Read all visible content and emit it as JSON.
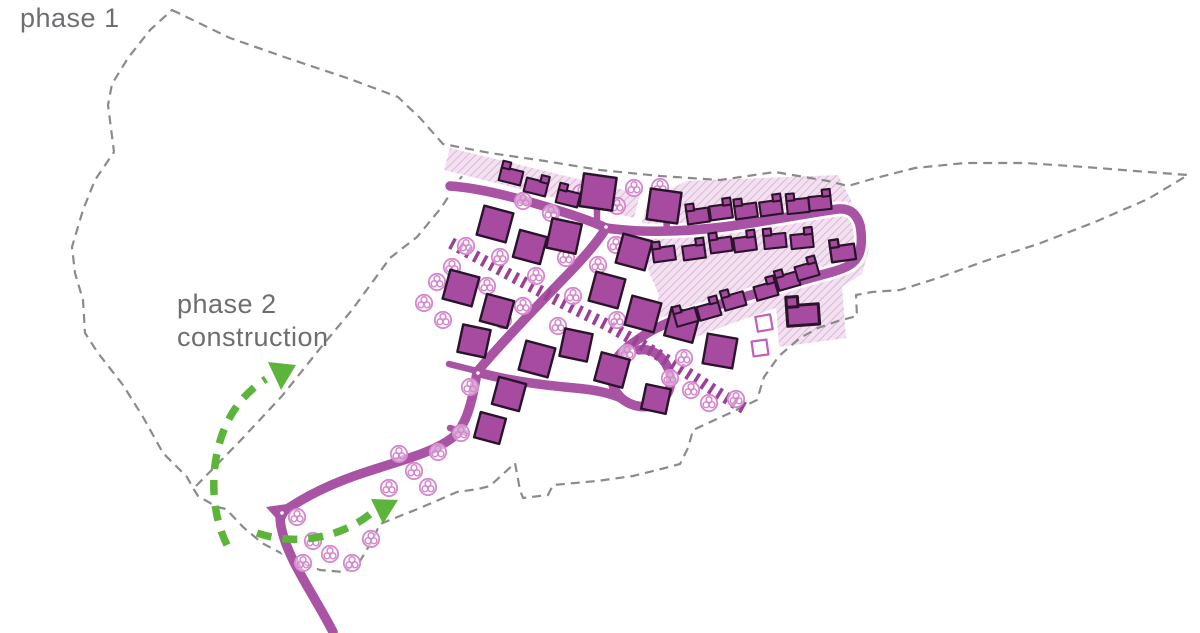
{
  "page": {
    "background": "#ffffff",
    "width": 1200,
    "height": 633
  },
  "labels": {
    "phase1": "phase 1",
    "phase2_line1": "phase 2",
    "phase2_line2": "construction"
  },
  "colors": {
    "road": "#a853a4",
    "footpath_tie": "#9c3f97",
    "building_fill": "#a74ba1",
    "building_outline": "#2a142b",
    "hatch_bg": "#f2e2f0",
    "hatch_line": "#dcabd7",
    "tree": "#d687ce",
    "boundary_dash": "#8b8b8b",
    "arrow_green": "#5cb53a",
    "label_text": "#6d6e71",
    "vacant_plot_outline": "#c35fba"
  },
  "plan": {
    "phase1_buildings": [
      [
        495,
        224,
        30,
        15
      ],
      [
        530,
        247,
        28,
        15
      ],
      [
        564,
        236,
        30,
        12
      ],
      [
        598,
        192,
        33,
        8
      ],
      [
        634,
        252,
        30,
        15
      ],
      [
        664,
        206,
        31,
        8
      ],
      [
        607,
        290,
        30,
        15
      ],
      [
        643,
        314,
        30,
        15
      ],
      [
        461,
        288,
        30,
        15
      ],
      [
        497,
        311,
        28,
        15
      ],
      [
        474,
        341,
        28,
        12
      ],
      [
        537,
        359,
        30,
        15
      ],
      [
        576,
        345,
        28,
        12
      ],
      [
        612,
        370,
        29,
        15
      ],
      [
        509,
        394,
        28,
        15
      ],
      [
        490,
        428,
        26,
        15
      ],
      [
        682,
        325,
        29,
        15
      ],
      [
        720,
        351,
        30,
        10
      ],
      [
        656,
        399,
        25,
        12
      ]
    ],
    "terraced_houses": [
      [
        511,
        176,
        14,
        1,
        0
      ],
      [
        536,
        187,
        14,
        1,
        1
      ],
      [
        568,
        198,
        14,
        1,
        0
      ],
      [
        698,
        216,
        -8,
        1,
        0
      ],
      [
        721,
        212,
        -8,
        1,
        1
      ],
      [
        746,
        211,
        -8,
        1,
        0
      ],
      [
        771,
        208,
        -8,
        1,
        1
      ],
      [
        798,
        206,
        -6,
        1,
        0
      ],
      [
        820,
        203,
        -6,
        1,
        1
      ],
      [
        664,
        254,
        -8,
        1,
        0
      ],
      [
        694,
        252,
        -8,
        1,
        1
      ],
      [
        721,
        245,
        -8,
        1,
        0
      ],
      [
        745,
        244,
        -8,
        1,
        1
      ],
      [
        775,
        241,
        -6,
        1,
        0
      ],
      [
        802,
        241,
        -6,
        1,
        1
      ],
      [
        843,
        253,
        -8,
        1.1,
        0
      ],
      [
        686,
        317,
        -16,
        1,
        0
      ],
      [
        709,
        311,
        -16,
        1,
        1
      ],
      [
        734,
        301,
        -16,
        1,
        0
      ],
      [
        766,
        291,
        -16,
        1,
        1
      ],
      [
        788,
        281,
        -16,
        1,
        0
      ],
      [
        807,
        271,
        -16,
        1,
        1
      ],
      [
        803,
        315,
        -4,
        1.45,
        0
      ]
    ],
    "vacant_plots": [
      [
        764,
        323,
        15,
        -10
      ],
      [
        760,
        348,
        15,
        -8
      ]
    ],
    "trees": [
      [
        297,
        517
      ],
      [
        313,
        541
      ],
      [
        303,
        563
      ],
      [
        330,
        554
      ],
      [
        352,
        563
      ],
      [
        371,
        539
      ],
      [
        399,
        454
      ],
      [
        414,
        471
      ],
      [
        428,
        487
      ],
      [
        438,
        452
      ],
      [
        461,
        433
      ],
      [
        389,
        488
      ],
      [
        437,
        282
      ],
      [
        424,
        303
      ],
      [
        443,
        320
      ],
      [
        503,
        320
      ],
      [
        470,
        387
      ],
      [
        523,
        201
      ],
      [
        551,
        213
      ],
      [
        581,
        193
      ],
      [
        617,
        206
      ],
      [
        634,
        188
      ],
      [
        660,
        187
      ],
      [
        616,
        245
      ],
      [
        598,
        265
      ],
      [
        566,
        258
      ],
      [
        466,
        246
      ],
      [
        452,
        267
      ],
      [
        500,
        257
      ],
      [
        487,
        286
      ],
      [
        536,
        276
      ],
      [
        523,
        306
      ],
      [
        573,
        296
      ],
      [
        558,
        326
      ],
      [
        617,
        320
      ],
      [
        627,
        353
      ],
      [
        670,
        378
      ],
      [
        691,
        390
      ],
      [
        709,
        403
      ],
      [
        736,
        399
      ],
      [
        684,
        358
      ]
    ]
  }
}
